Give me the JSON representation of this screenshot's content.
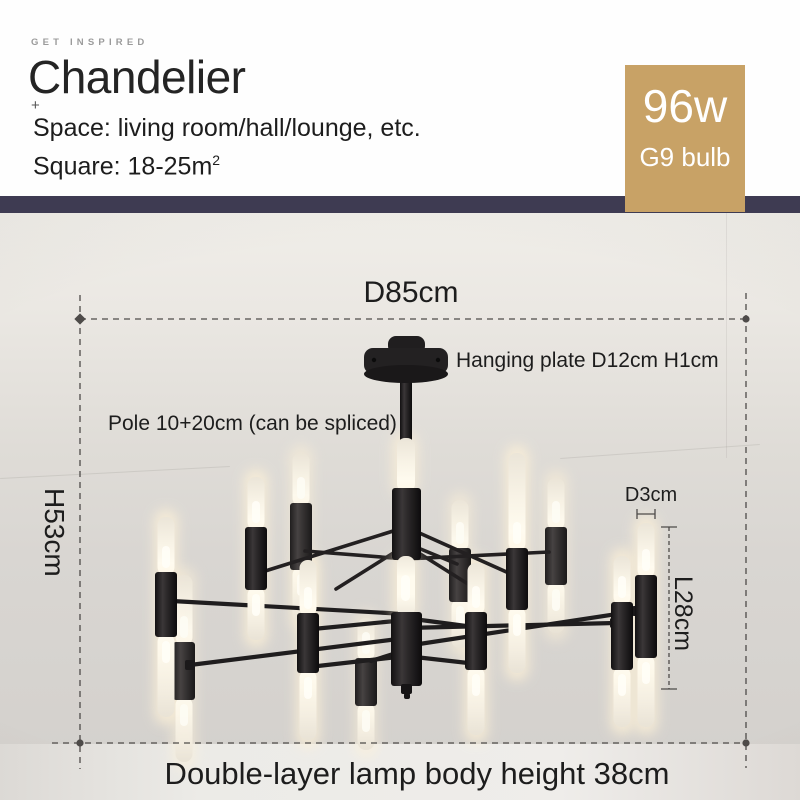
{
  "header": {
    "eyebrow": "GET INSPIRED",
    "title": "Chandelier",
    "plus": "+",
    "space_line": "Space: living room/hall/lounge, etc.",
    "square_prefix": "Square: 18-25m",
    "square_sup": "2"
  },
  "badge": {
    "wattage": "96w",
    "bulb_type": "G9 bulb"
  },
  "annotations": {
    "width": "D85cm",
    "hanging_plate": "Hanging plate D12cm H1cm",
    "pole": "Pole 10+20cm (can be spliced)",
    "height": "H53cm",
    "tube_diameter": "D3cm",
    "tube_length": "L28cm",
    "body_height": "Double-layer lamp body height 38cm"
  },
  "colors": {
    "badge_bg": "#c8a266",
    "badge_text": "#ffffff",
    "divider": "#3e3b52",
    "dimension_line": "#4e4b49",
    "text": "#1d1d1d"
  }
}
